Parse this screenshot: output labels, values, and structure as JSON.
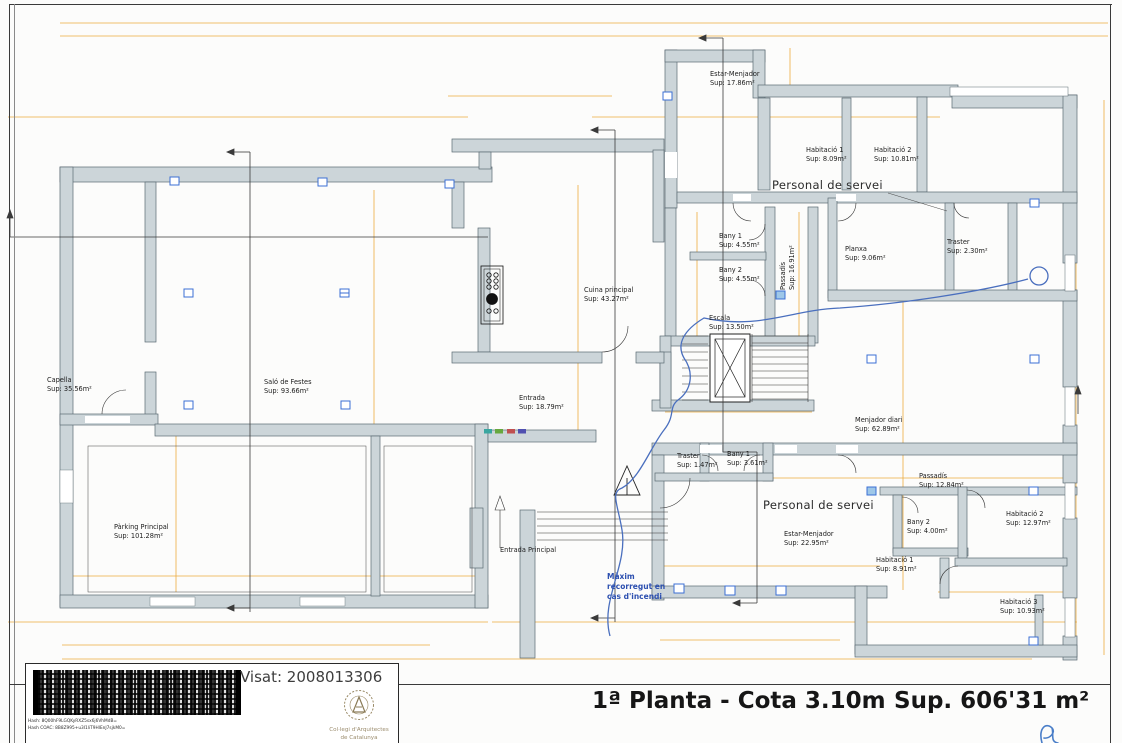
{
  "footer": {
    "plan_title": "1ª Planta - Cota 3.10m",
    "area_total": "Sup. 606'31 m²"
  },
  "title_block": {
    "visat": "Visat: 2008013306",
    "info_lines": [
      "Obra completa classificacions",
      "Edifici de 1 vivenda de 1.024,06 m2",
      "Ús del local: Rehabilitació",
      "Emplaçament: Car Partagàs 39, Sant Cebrià",
      "Arquitecte: Vila Travers, Isidre Lluís",
      "Client: Pisan Vidal, Joan Lluís"
    ],
    "hash_line1": "Hash: 8Q00hF9LGQKyRXZ5sx6j6VhMdB=",
    "hash_line2": "Hash COAC: 8B8Z995+u3I1liT9HlEnJ7sjkM0=",
    "seal_caption1": "Col·legi d'Arquitectes",
    "seal_caption2": "de Catalunya"
  },
  "colors": {
    "dimension_text": "#E2A433",
    "wall_fill": "#CCD5D9",
    "fire_route": "#4A6FBE",
    "fire_text": "#2D50B0",
    "column_marker": "#3B6FD4"
  },
  "plan": {
    "fire_note": "Màxim\nrecorregut en\ncas d'incendi",
    "rooms": [
      {
        "name": "Capella",
        "sup": "Sup: 35.56m²",
        "x": 47,
        "y": 376
      },
      {
        "name": "Saló de Festes",
        "sup": "Sup: 93.66m²",
        "x": 264,
        "y": 378
      },
      {
        "name": "Pàrking Principal",
        "sup": "Sup: 101.28m²",
        "x": 114,
        "y": 523
      },
      {
        "name": "Entrada",
        "sup": "Sup: 18.79m²",
        "x": 519,
        "y": 394
      },
      {
        "name": "Cuina principal",
        "sup": "Sup: 43.27m²",
        "x": 584,
        "y": 286
      },
      {
        "name": "Estar-Menjador",
        "sup": "Sup: 17.86m²",
        "x": 710,
        "y": 70
      },
      {
        "name": "Habitació 1",
        "sup": "Sup: 8.09m²",
        "x": 806,
        "y": 146
      },
      {
        "name": "Habitació 2",
        "sup": "Sup: 10.81m²",
        "x": 874,
        "y": 146
      },
      {
        "name": "Personal de servei",
        "cls": "big",
        "x": 772,
        "y": 178
      },
      {
        "name": "Bany 1",
        "sup": "Sup: 4.55m²",
        "x": 719,
        "y": 232
      },
      {
        "name": "Bany 2",
        "sup": "Sup: 4.55m²",
        "x": 719,
        "y": 266
      },
      {
        "name": "Passadís",
        "sup": "Sup: 16.91m²",
        "cls": "v",
        "x": 779,
        "y": 290
      },
      {
        "name": "Planxa",
        "sup": "Sup: 9.06m²",
        "x": 845,
        "y": 245
      },
      {
        "name": "Traster",
        "sup": "Sup: 2.30m²",
        "x": 947,
        "y": 238
      },
      {
        "name": "Escala",
        "sup": "Sup: 13.50m²",
        "x": 709,
        "y": 314
      },
      {
        "name": "Menjador diari",
        "sup": "Sup: 62.89m²",
        "x": 855,
        "y": 416
      },
      {
        "name": "Traster",
        "sup": "Sup: 1.47m²",
        "x": 677,
        "y": 452
      },
      {
        "name": "Bany 1",
        "sup": "Sup: 3.61m²",
        "x": 727,
        "y": 450
      },
      {
        "name": "Personal de servei",
        "cls": "big",
        "x": 763,
        "y": 498
      },
      {
        "name": "Estar-Menjador",
        "sup": "Sup: 22.95m²",
        "x": 784,
        "y": 530
      },
      {
        "name": "Passadís",
        "sup": "Sup: 12.84m²",
        "x": 919,
        "y": 472
      },
      {
        "name": "Bany 2",
        "sup": "Sup: 4.00m²",
        "x": 907,
        "y": 518
      },
      {
        "name": "Habitació 1",
        "sup": "Sup: 8.91m²",
        "x": 876,
        "y": 556
      },
      {
        "name": "Habitació 2",
        "sup": "Sup: 12.97m²",
        "x": 1006,
        "y": 510
      },
      {
        "name": "Habitació 3",
        "sup": "Sup: 10.93m²",
        "x": 1000,
        "y": 598
      },
      {
        "name": "Entrada Principal",
        "x": 500,
        "y": 546
      }
    ],
    "markers": [
      {
        "t": "A",
        "x": 703,
        "y": 2
      },
      {
        "t": "A'",
        "x": 786,
        "y": 610
      },
      {
        "t": "B",
        "x": 245,
        "y": 126
      },
      {
        "t": "B'",
        "x": 241,
        "y": 618
      },
      {
        "t": "C",
        "x": 606,
        "y": 96
      },
      {
        "t": "C'",
        "x": 597,
        "y": 624
      },
      {
        "t": "D",
        "x": 1,
        "y": 192
      },
      {
        "t": "D'",
        "x": 1057,
        "y": 348
      }
    ],
    "dims": [
      {
        "t": "37.4",
        "x": 938,
        "y": 11
      },
      {
        "t": "16.45",
        "x": 248,
        "y": 24
      },
      {
        "t": "6.64",
        "x": 583,
        "y": 24
      },
      {
        "t": "4.64",
        "x": 753,
        "y": 24
      },
      {
        "t": "9.96",
        "x": 921,
        "y": 24
      },
      {
        "t": "4.31",
        "x": 1044,
        "y": 24
      },
      {
        "t": "1.19",
        "x": 452,
        "y": 86
      },
      {
        "t": "1.7",
        "x": 498,
        "y": 86
      },
      {
        "t": "1.28",
        "x": 578,
        "y": 86
      },
      {
        "t": "0.3",
        "x": 10,
        "y": 109
      },
      {
        "t": "4.15",
        "x": 84,
        "y": 109
      },
      {
        "t": "0.45",
        "x": 146,
        "y": 109
      },
      {
        "t": "11.54",
        "x": 315,
        "y": 109
      },
      {
        "t": "0.45",
        "x": 450,
        "y": 109
      },
      {
        "t": "0.19",
        "x": 588,
        "y": 109
      },
      {
        "t": "3.3",
        "x": 740,
        "y": 109
      },
      {
        "t": "2.48",
        "x": 806,
        "y": 109
      },
      {
        "t": "2.46",
        "x": 876,
        "y": 109
      },
      {
        "t": "2.2",
        "x": 922,
        "y": 109
      },
      {
        "t": "0.9",
        "x": 789,
        "y": 53,
        "cls": "v"
      },
      {
        "t": "0.9",
        "x": 789,
        "y": 75,
        "cls": "v"
      },
      {
        "t": "6.36",
        "x": 693,
        "y": 130,
        "cls": "v"
      },
      {
        "t": "3.32",
        "x": 723,
        "y": 199
      },
      {
        "t": "0.1",
        "x": 770,
        "y": 196
      },
      {
        "t": "1.75",
        "x": 795,
        "y": 199
      },
      {
        "t": "0.85",
        "x": 938,
        "y": 175
      },
      {
        "t": "4.03",
        "x": 879,
        "y": 228
      },
      {
        "t": "2.42",
        "x": 922,
        "y": 227
      },
      {
        "t": "1.98",
        "x": 957,
        "y": 230
      },
      {
        "t": "1.37",
        "x": 695,
        "y": 236,
        "cls": "v"
      },
      {
        "t": "1.37",
        "x": 695,
        "y": 277,
        "cls": "v"
      },
      {
        "t": "4.07",
        "x": 797,
        "y": 248,
        "cls": "v"
      },
      {
        "t": "7.1",
        "x": 576,
        "y": 244,
        "cls": "v"
      },
      {
        "t": "3.12",
        "x": 574,
        "y": 334,
        "cls": "v"
      },
      {
        "t": "3.98",
        "x": 575,
        "y": 392,
        "cls": "v"
      },
      {
        "t": "6.26",
        "x": 899,
        "y": 294
      },
      {
        "t": "2.7",
        "x": 1010,
        "y": 294
      },
      {
        "t": "2.51",
        "x": 1069,
        "y": 289,
        "cls": "v"
      },
      {
        "t": "7.16",
        "x": 902,
        "y": 363,
        "cls": "v"
      },
      {
        "t": "21.65",
        "x": 1102,
        "y": 349,
        "cls": "v"
      },
      {
        "t": "4.01",
        "x": 739,
        "y": 405
      },
      {
        "t": "3.38",
        "x": 798,
        "y": 353,
        "cls": "v"
      },
      {
        "t": "2.46",
        "x": 751,
        "y": 435,
        "cls": "v"
      },
      {
        "t": "0.53",
        "x": 720,
        "y": 479
      },
      {
        "t": "2.26",
        "x": 742,
        "y": 477
      },
      {
        "t": "0.11",
        "x": 793,
        "y": 456
      },
      {
        "t": "1.39",
        "x": 801,
        "y": 474
      },
      {
        "t": "5.49",
        "x": 882,
        "y": 474
      },
      {
        "t": "0.1",
        "x": 889,
        "y": 529,
        "cls": "v"
      },
      {
        "t": "6.39",
        "x": 776,
        "y": 562
      },
      {
        "t": "3.58",
        "x": 769,
        "y": 536,
        "cls": "v"
      },
      {
        "t": "5.05",
        "x": 1018,
        "y": 587
      },
      {
        "t": "2.58",
        "x": 1073,
        "y": 533,
        "cls": "v"
      },
      {
        "t": "0.7",
        "x": 1081,
        "y": 557,
        "cls": "v"
      },
      {
        "t": "0.58",
        "x": 1081,
        "y": 573,
        "cls": "v"
      },
      {
        "t": "6.25",
        "x": 101,
        "y": 571
      },
      {
        "t": "0.4",
        "x": 197,
        "y": 571
      },
      {
        "t": "3.5",
        "x": 251,
        "y": 571
      },
      {
        "t": "0.4",
        "x": 305,
        "y": 571
      },
      {
        "t": "3.5",
        "x": 367,
        "y": 571
      },
      {
        "t": "0.4",
        "x": 414,
        "y": 571
      },
      {
        "t": "2",
        "x": 451,
        "y": 571
      },
      {
        "t": "1.7",
        "x": 174,
        "y": 445,
        "cls": "v"
      },
      {
        "t": "5",
        "x": 174,
        "y": 511,
        "cls": "v"
      },
      {
        "t": "6.29",
        "x": 372,
        "y": 293,
        "cls": "v"
      },
      {
        "t": "0.3",
        "x": 10,
        "y": 615
      },
      {
        "t": "0.3",
        "x": 472,
        "y": 615
      },
      {
        "t": "6.02",
        "x": 570,
        "y": 617
      },
      {
        "t": "0.44",
        "x": 666,
        "y": 617
      },
      {
        "t": "6.8",
        "x": 769,
        "y": 617
      },
      {
        "t": "2.5",
        "x": 861,
        "y": 619
      },
      {
        "t": "1.5",
        "x": 904,
        "y": 619
      },
      {
        "t": "0.5",
        "x": 942,
        "y": 619
      },
      {
        "t": "1.5",
        "x": 994,
        "y": 619
      },
      {
        "t": "1.15",
        "x": 1040,
        "y": 619
      },
      {
        "t": "0.4",
        "x": 1072,
        "y": 619
      },
      {
        "t": "6.25",
        "x": 101,
        "y": 640
      },
      {
        "t": "0.4",
        "x": 197,
        "y": 640
      },
      {
        "t": "3.5",
        "x": 251,
        "y": 640
      },
      {
        "t": "0.4",
        "x": 305,
        "y": 640
      },
      {
        "t": "3.5",
        "x": 367,
        "y": 640
      },
      {
        "t": "1.68",
        "x": 684,
        "y": 636
      },
      {
        "t": "0.8",
        "x": 722,
        "y": 636
      },
      {
        "t": "2.44",
        "x": 772,
        "y": 636
      },
      {
        "t": "0.8",
        "x": 812,
        "y": 636
      },
      {
        "t": "1.87",
        "x": 884,
        "y": 664
      },
      {
        "t": "0.8",
        "x": 928,
        "y": 664
      },
      {
        "t": "38.57",
        "x": 543,
        "y": 653
      }
    ]
  }
}
